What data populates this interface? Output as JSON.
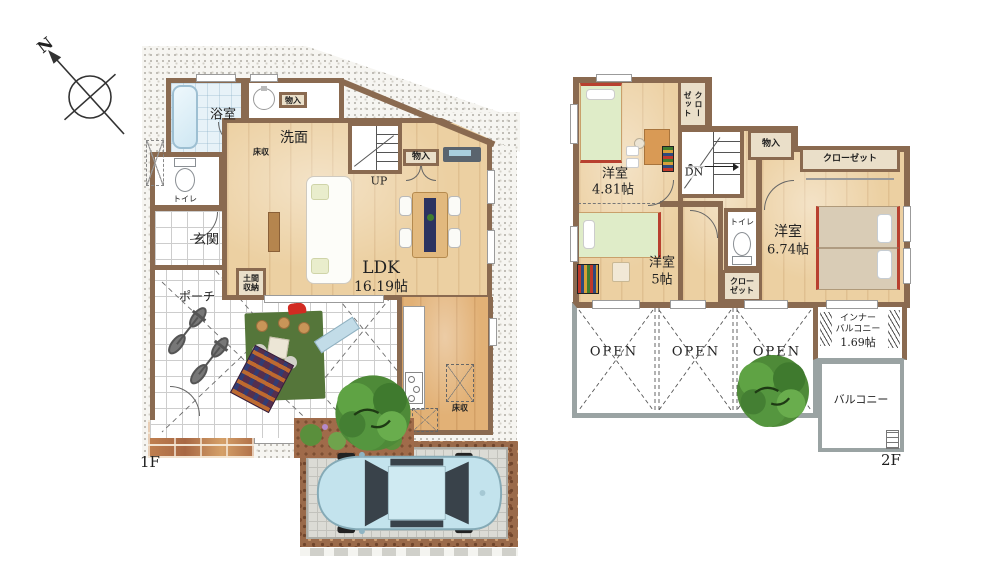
{
  "compass": {
    "north": "N"
  },
  "palette": {
    "wall": "#8a6a50",
    "wood": "#ecd0a2",
    "wood_dark": "#e2b176",
    "bath_blue": "#cfe7f3",
    "beige_box": "#eadfc9",
    "mat_green": "#55763a",
    "tree_green": "#4e8a38",
    "car_blue": "#c3e3ed",
    "brick": "#bd7c50",
    "open_border": "#9aa3a3",
    "bed_green": "#dfecc8",
    "bed_red_trim": "#b8402f"
  },
  "floor1": {
    "label": "1F",
    "bathroom": "浴室",
    "washroom": "洗面",
    "storage_wash": "物入",
    "floor_storage_wash": "床収",
    "toilet": "トイレ",
    "entrance": "玄関",
    "doma_storage": "土間収納",
    "porch": "ポーチ",
    "stairs_up": "UP",
    "ldk_name": "LDK",
    "ldk_size": "16.19帖",
    "storage_ldk": "物入",
    "floor_storage_kitchen": "床収"
  },
  "floor2": {
    "label": "2F",
    "bedroom1_name": "洋室",
    "bedroom1_size": "4.81帖",
    "closet_top": "クローゼット",
    "stairs_down": "DN",
    "storage": "物入",
    "closet_right": "クローゼット",
    "bedroom2_name": "洋室",
    "bedroom2_size": "5帖",
    "toilet": "トイレ",
    "closet_mid": "クローゼット",
    "bedroom3_name": "洋室",
    "bedroom3_size": "6.74帖",
    "open_1": "OPEN",
    "open_2": "OPEN",
    "open_3": "OPEN",
    "inner_balcony_line1": "インナー",
    "inner_balcony_line2": "バルコニー",
    "inner_balcony_size": "1.69帖",
    "balcony": "バルコニー"
  }
}
